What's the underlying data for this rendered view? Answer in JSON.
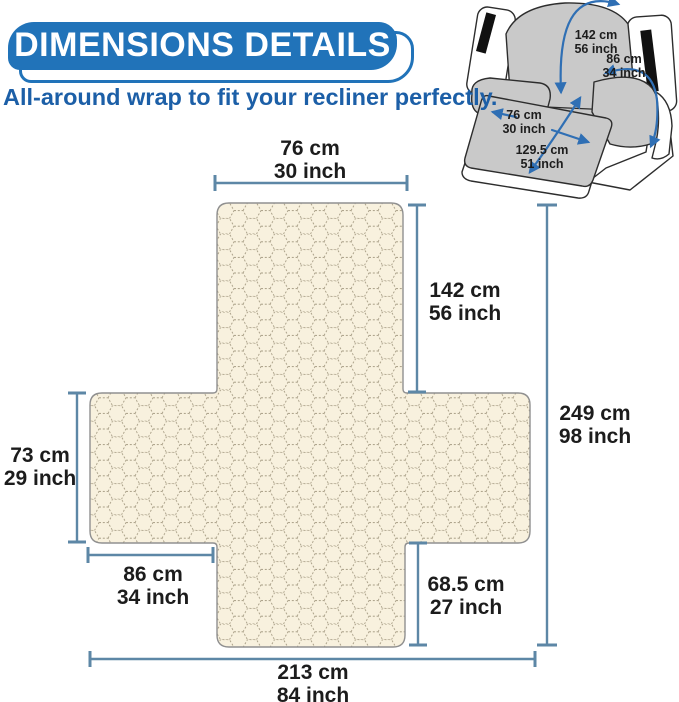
{
  "header": {
    "title": "DIMENSIONS DETAILS",
    "subtitle": "All-around wrap to fit your recliner perfectly."
  },
  "colors": {
    "banner_blue": "#2173b9",
    "subtitle_blue": "#1c5fa7",
    "dimension_line_blue": "#5d87a6",
    "arrow_blue": "#2f6fb4",
    "label_text": "#1c1c1c",
    "fabric_fill": "#f8f1de",
    "fabric_pattern_stroke": "#a79d85",
    "fabric_border": "#909090",
    "recliner_gray": "#c9c9c9",
    "recliner_outline": "#2d2d2d",
    "strap_black": "#111111"
  },
  "flat_diagram": {
    "dimensions": [
      {
        "id": "top-width",
        "cm": "76 cm",
        "inch": "30 inch"
      },
      {
        "id": "back-height",
        "cm": "142 cm",
        "inch": "56 inch"
      },
      {
        "id": "total-height",
        "cm": "249 cm",
        "inch": "98 inch"
      },
      {
        "id": "left-wing-height",
        "cm": "73 cm",
        "inch": "29 inch"
      },
      {
        "id": "left-wing-width",
        "cm": "86 cm",
        "inch": "34 inch"
      },
      {
        "id": "bottom-right-height",
        "cm": "68.5 cm",
        "inch": "27 inch"
      },
      {
        "id": "total-width",
        "cm": "213 cm",
        "inch": "84 inch"
      }
    ]
  },
  "recliner_inset": {
    "labels": [
      {
        "id": "back-length",
        "cm": "142 cm",
        "inch": "56 inch"
      },
      {
        "id": "arm-wrap",
        "cm": "86 cm",
        "inch": "34 inch"
      },
      {
        "id": "footrest-width",
        "cm": "76 cm",
        "inch": "30 inch"
      },
      {
        "id": "seat-length",
        "cm": "129.5 cm",
        "inch": "51 inch"
      }
    ]
  }
}
